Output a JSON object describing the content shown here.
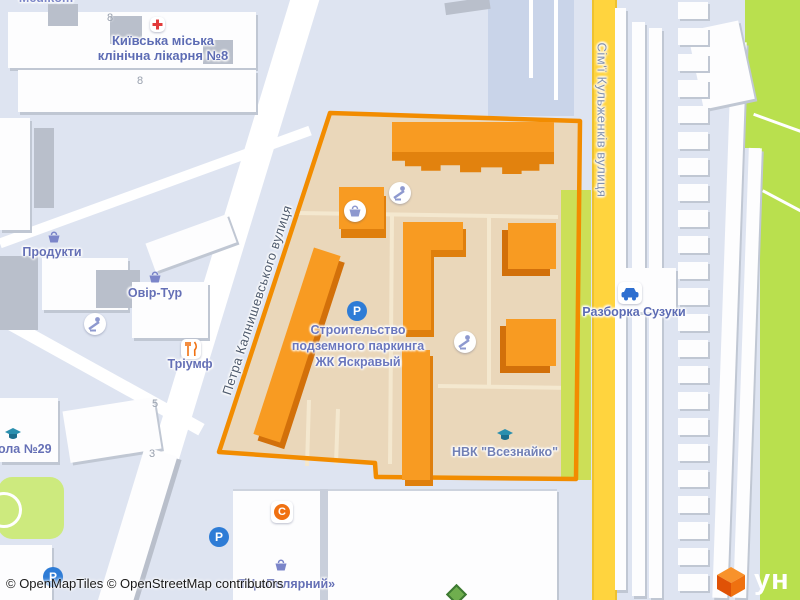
{
  "attribution": "© OpenMapTiles © OpenStreetMap contributors",
  "watermark": {
    "text": "ун"
  },
  "streets": {
    "kalnyshevskoho": "Петра Калнишевського вулиця",
    "kulzhenkiv": "Сім'ї Кульженків вулиця"
  },
  "pois": {
    "medikom": "Medikom",
    "hospital": {
      "line1": "Київська міська",
      "line2": "клінічна лікарня №8"
    },
    "produkty": "Продукти",
    "ovir_tur": "Овір-Тур",
    "triumf": "Тріумф",
    "school_29": "ола №29",
    "vseznaiko": "НВК \"Всезнайко\"",
    "suzuki": "Разборка Сузуки",
    "polyarnyi": "ТЦ «Полярний»"
  },
  "construction": {
    "line1": "Строительство",
    "line2": "подземного паркинга",
    "line3": "ЖК Яскравый"
  },
  "house_numbers": {
    "a": "8",
    "b": "8",
    "c": "5",
    "d": "3"
  },
  "icon_glyphs": {
    "parking": "P",
    "c_badge": "C"
  },
  "colors": {
    "highlight_border": "#f28c00",
    "highlight_fill": "#ead7ba",
    "building_orange": "#f89b22",
    "building_orange_side": "#df7f0d",
    "road_yellow": "#ffd43e",
    "greenery": "#b9e04e",
    "poi_label": "#6570b6",
    "parking_blue": "#2e7cd6"
  }
}
